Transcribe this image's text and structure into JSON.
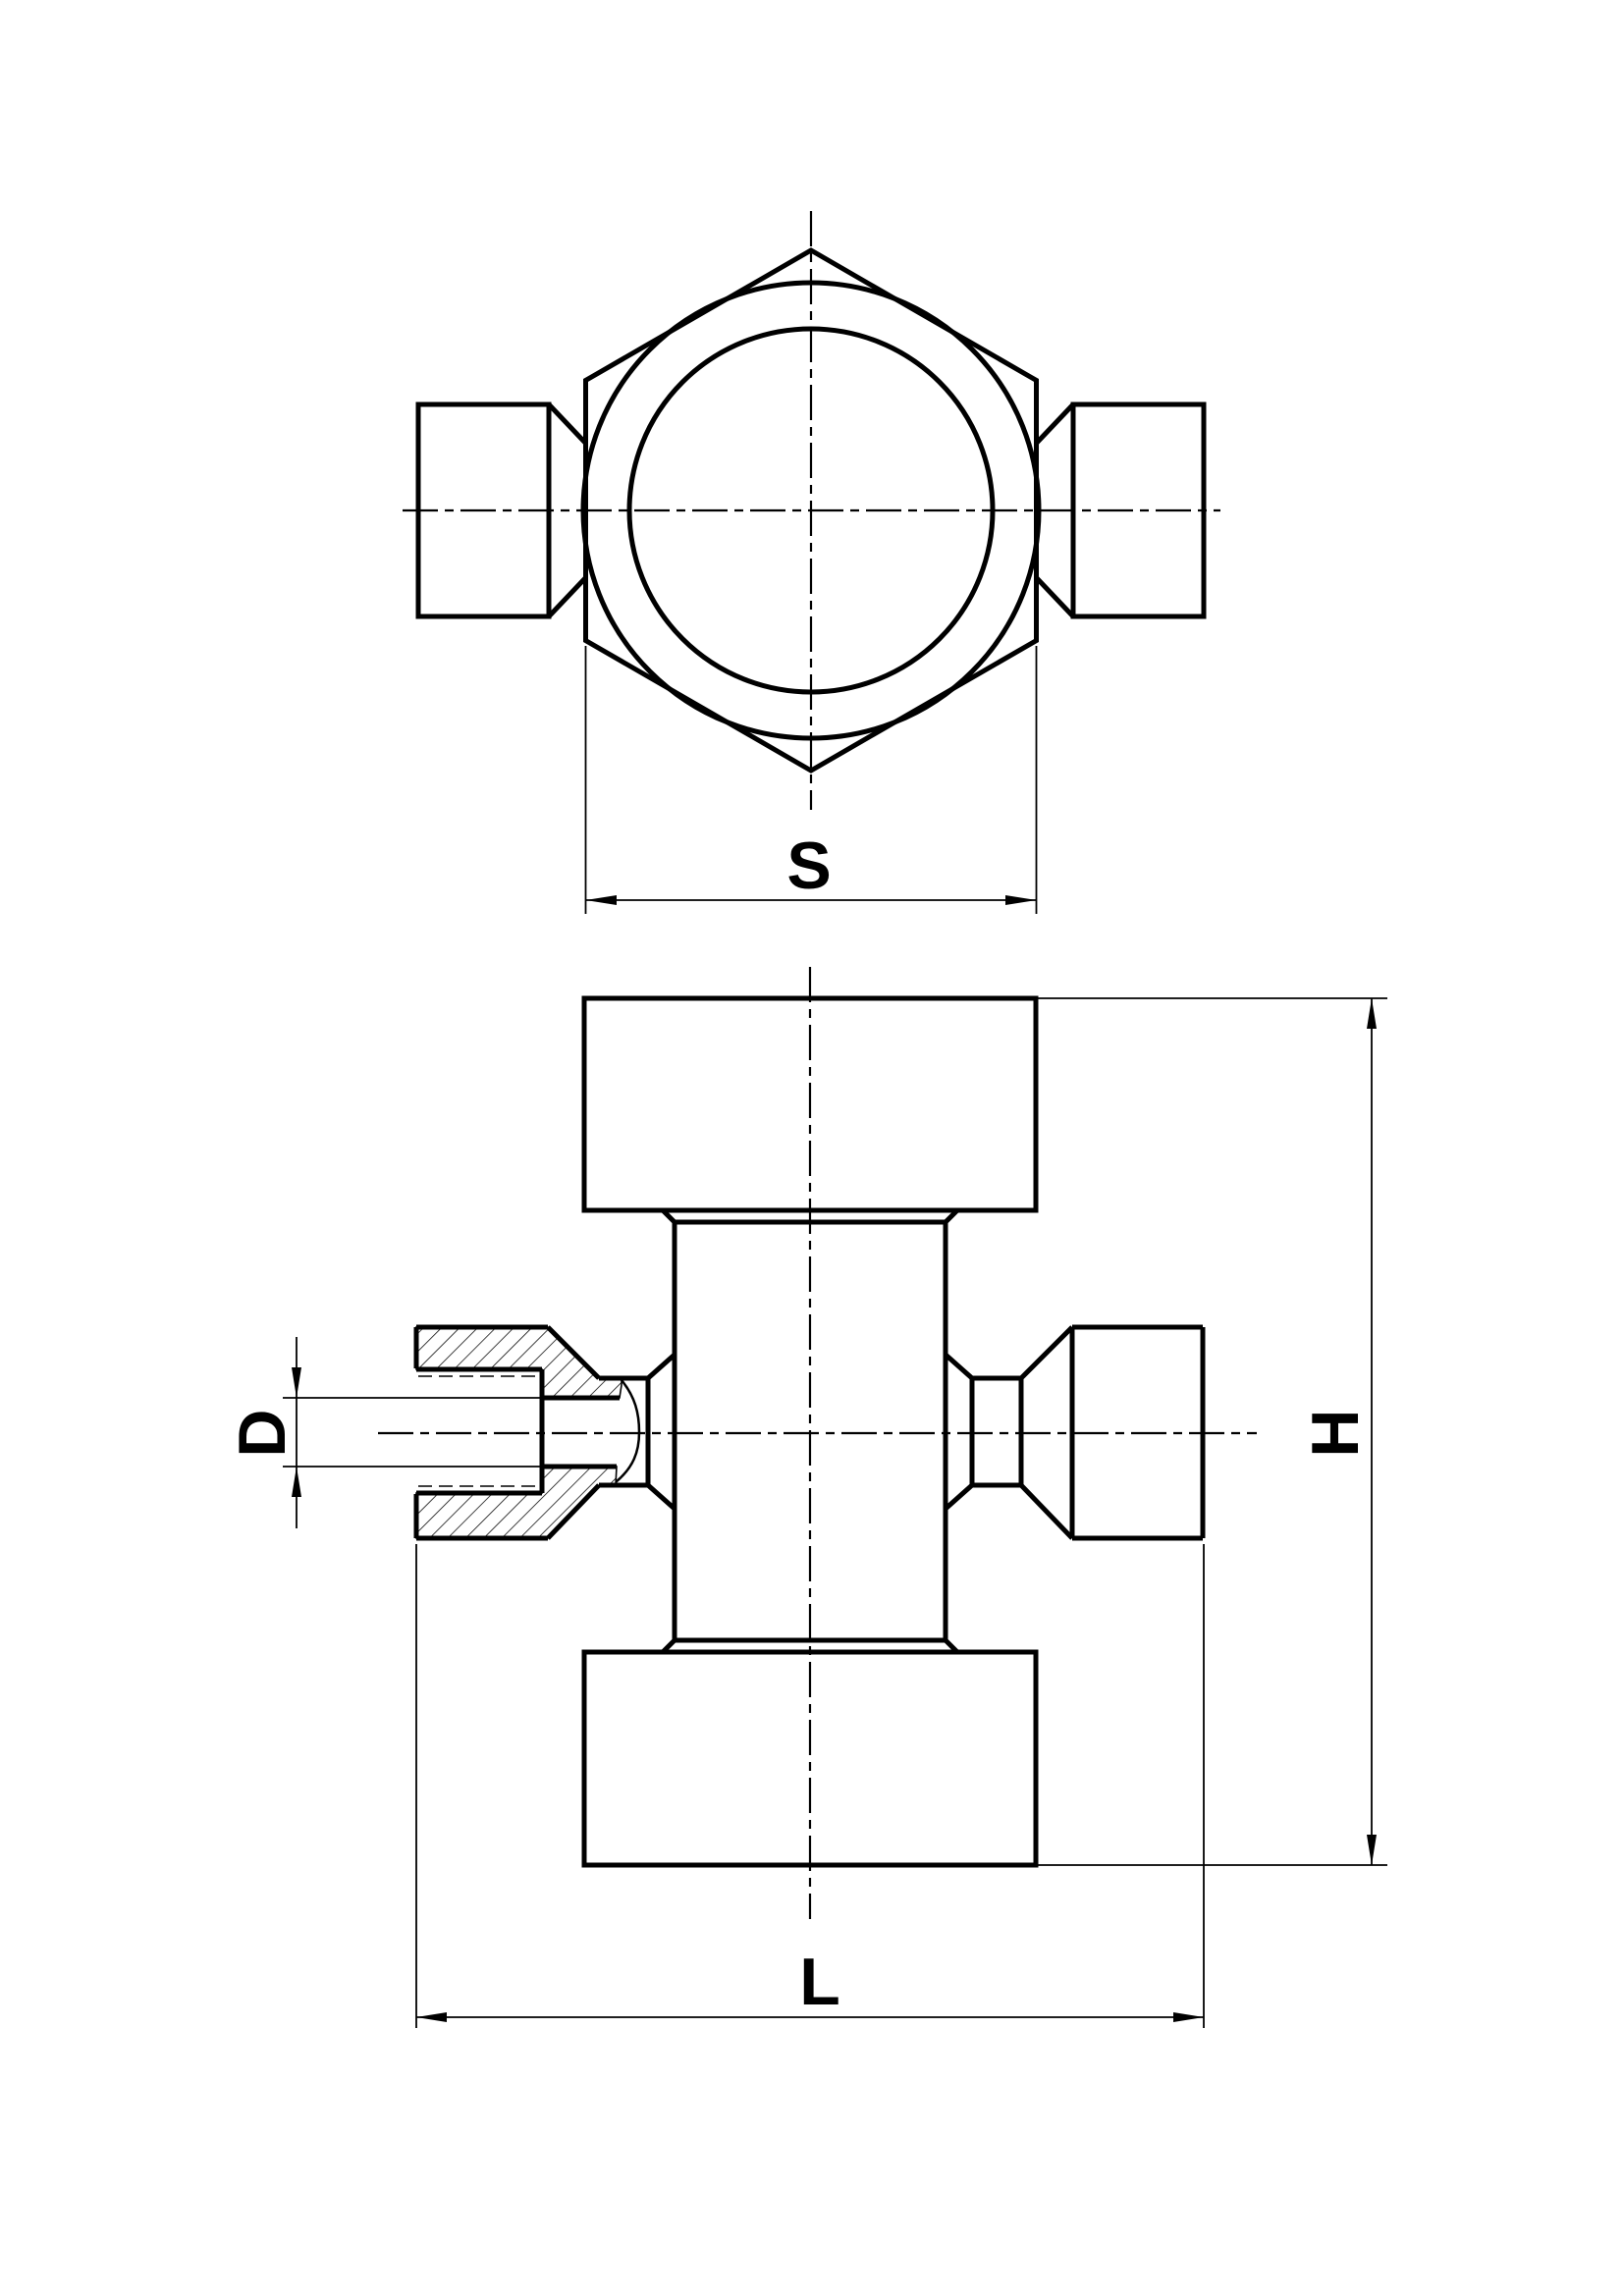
{
  "drawing": {
    "type": "technical-2d-engineering-drawing",
    "background_color": "#ffffff",
    "line_color": "#000000"
  },
  "dimensions": {
    "s": {
      "label": "S"
    },
    "d": {
      "label": "D"
    },
    "h": {
      "label": "H"
    },
    "l": {
      "label": "L"
    }
  }
}
